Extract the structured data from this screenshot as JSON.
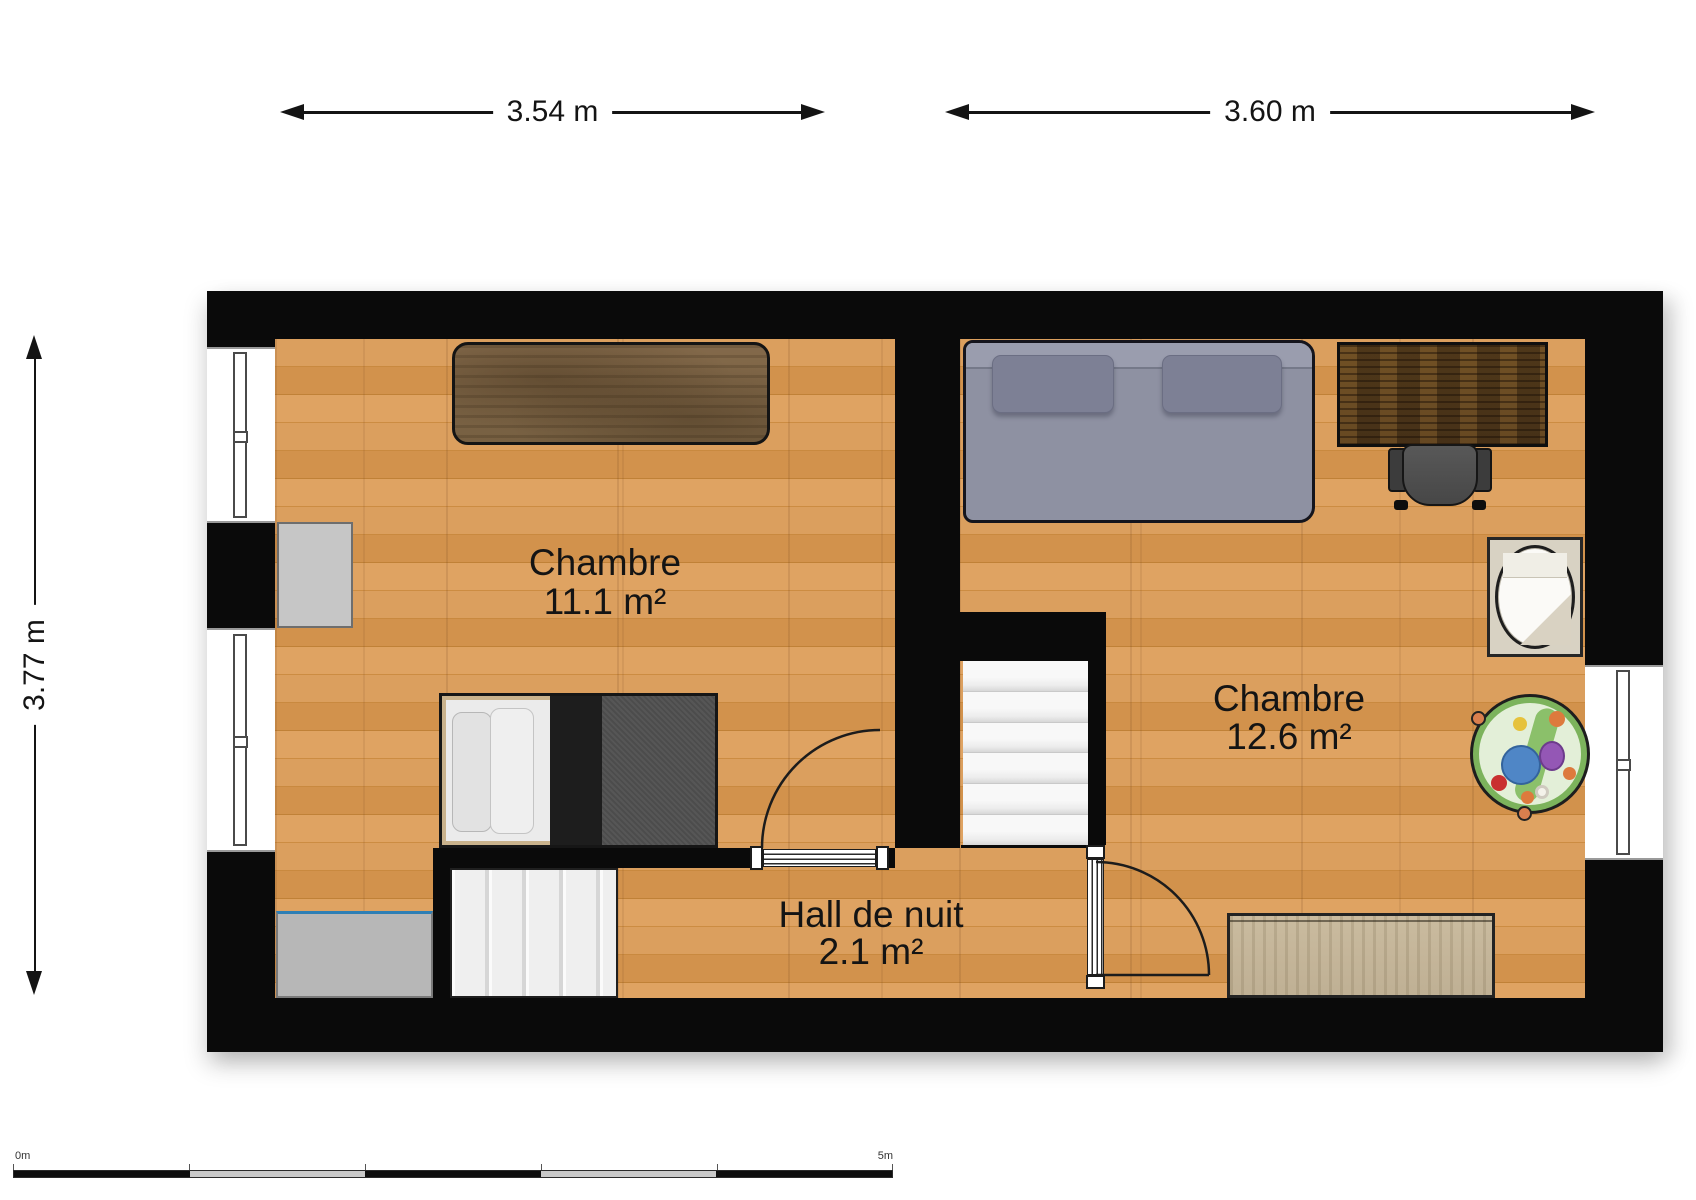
{
  "dimensions": {
    "room1_width": "3.54 m",
    "room2_width": "3.60 m",
    "overall_height": "3.77 m"
  },
  "rooms": [
    {
      "name": "Chambre",
      "area": "11.1 m²"
    },
    {
      "name": "Chambre",
      "area": "12.6 m²"
    },
    {
      "name": "Hall de nuit",
      "area": "2.1 m²"
    }
  ],
  "scale_bar": {
    "start_label": "0m",
    "end_label": "5m",
    "segment_count": 5
  },
  "colors": {
    "wall": "#0a0a0a",
    "floor_wood": "#d59753",
    "double_bed_gray": "#8e91a2",
    "single_bed_duvet": "#4c4c4c",
    "play_mat_green": "#7cb35c",
    "dresser_blue_edge": "#2e7fb5",
    "desk_left_brown": "#7d6647",
    "desk_right_brown": "#5e4528",
    "stairs": "#f0f0f0"
  }
}
